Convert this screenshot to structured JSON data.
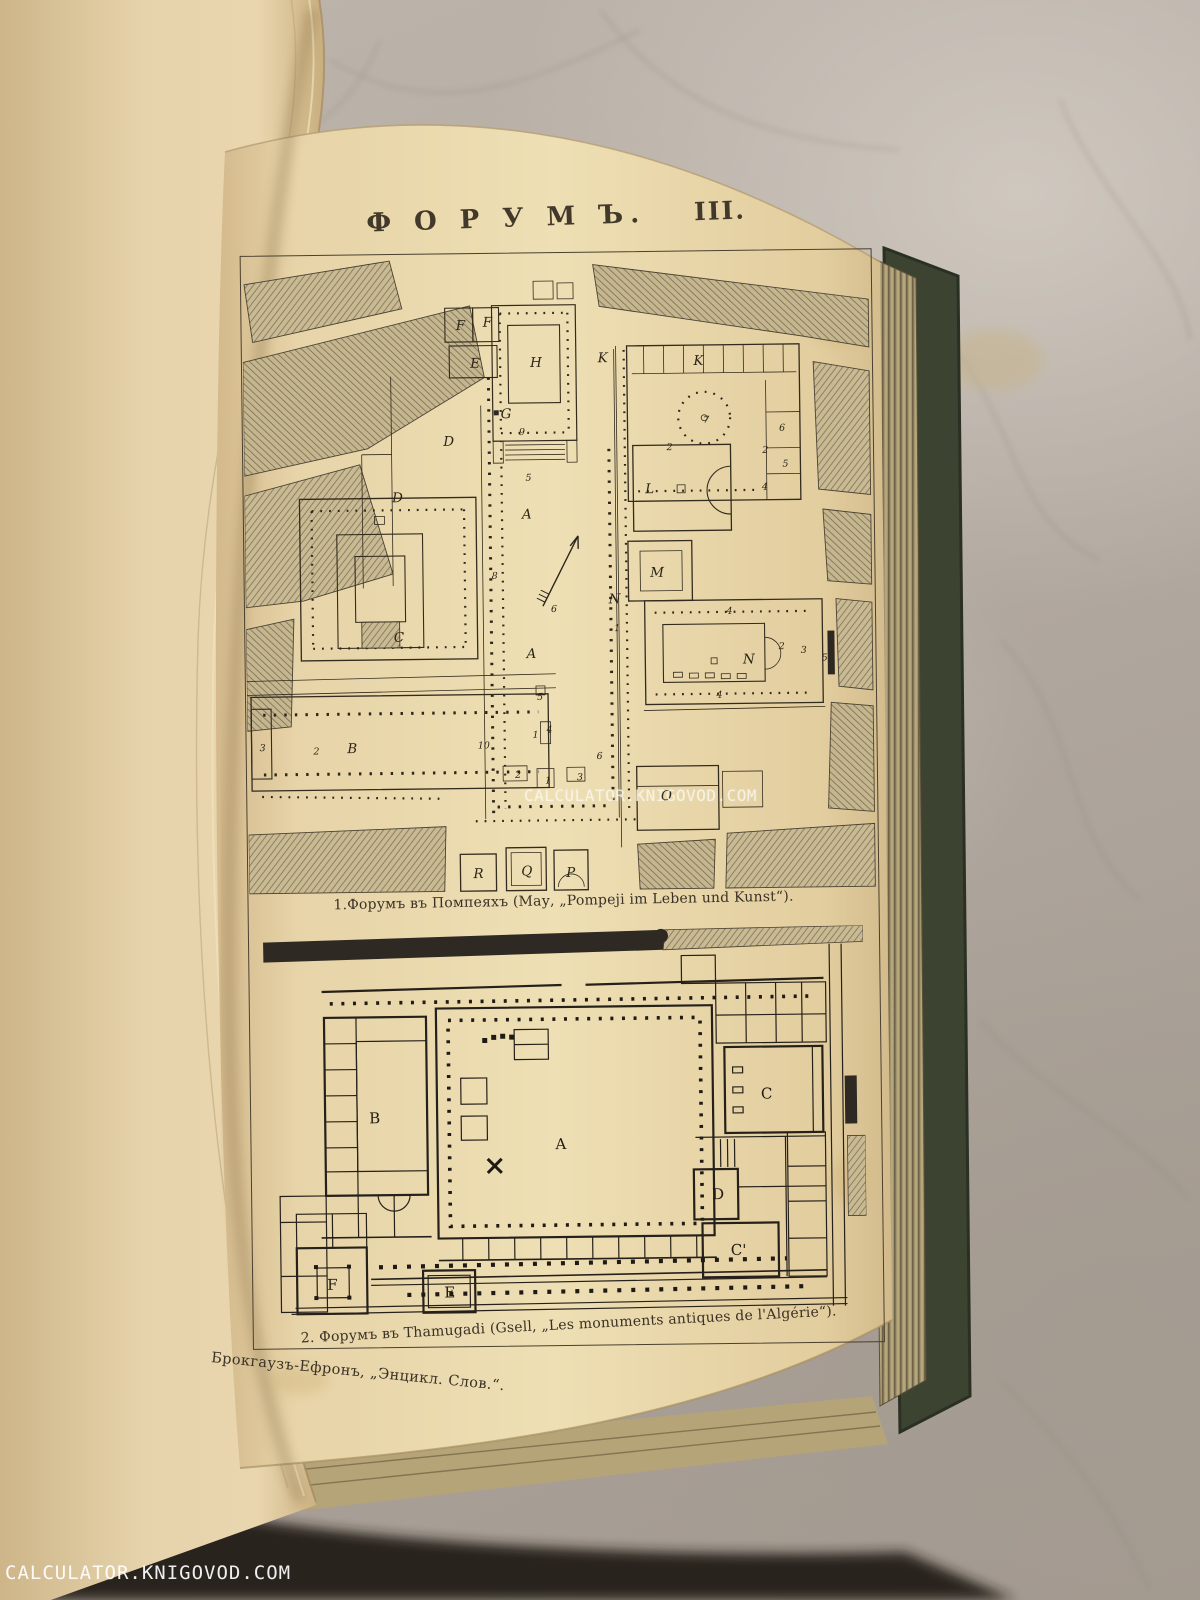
{
  "watermarks": {
    "center": "CALCULATOR.KNIGOVOD.COM",
    "corner": "CALCULATOR.KNIGOVOD.COM"
  },
  "plate": {
    "title": "Ф О Р У М Ъ.",
    "title_numeral": "III.",
    "fig1": {
      "caption": "1.Форумъ въ Помпеяхъ (Мау, „Pompeji im Leben und Kunst“).",
      "letters": [
        {
          "t": "F",
          "x": 214,
          "y": 74
        },
        {
          "t": "F",
          "x": 241,
          "y": 71
        },
        {
          "t": "E",
          "x": 228,
          "y": 112
        },
        {
          "t": "D",
          "x": 200,
          "y": 190
        },
        {
          "t": "D",
          "x": 148,
          "y": 246
        },
        {
          "t": "G",
          "x": 258,
          "y": 163
        },
        {
          "t": "H",
          "x": 288,
          "y": 112
        },
        {
          "t": "K",
          "x": 356,
          "y": 108
        },
        {
          "t": "K",
          "x": 452,
          "y": 112
        },
        {
          "t": "L",
          "x": 402,
          "y": 240
        },
        {
          "t": "M",
          "x": 406,
          "y": 324
        },
        {
          "t": "N",
          "x": 364,
          "y": 350
        },
        {
          "t": "N",
          "x": 498,
          "y": 412
        },
        {
          "t": "A",
          "x": 278,
          "y": 264
        },
        {
          "t": "A",
          "x": 281,
          "y": 404
        },
        {
          "t": "C",
          "x": 148,
          "y": 386
        },
        {
          "t": "B",
          "x": 100,
          "y": 497
        },
        {
          "t": "O",
          "x": 414,
          "y": 548
        },
        {
          "t": "R",
          "x": 225,
          "y": 624
        },
        {
          "t": "Q",
          "x": 273,
          "y": 622
        },
        {
          "t": "P",
          "x": 318,
          "y": 624
        }
      ],
      "numbers": [
        {
          "t": "9",
          "x": 276,
          "y": 180
        },
        {
          "t": "5",
          "x": 282,
          "y": 226
        },
        {
          "t": "8",
          "x": 247,
          "y": 324
        },
        {
          "t": "6",
          "x": 306,
          "y": 358
        },
        {
          "t": "10",
          "x": 231,
          "y": 494
        },
        {
          "t": "5",
          "x": 291,
          "y": 446
        },
        {
          "t": "4",
          "x": 300,
          "y": 479
        },
        {
          "t": "2",
          "x": 268,
          "y": 524
        },
        {
          "t": "1",
          "x": 298,
          "y": 530
        },
        {
          "t": "3",
          "x": 330,
          "y": 527
        },
        {
          "t": "6",
          "x": 350,
          "y": 506
        },
        {
          "t": "7",
          "x": 461,
          "y": 170
        },
        {
          "t": "2",
          "x": 424,
          "y": 197
        },
        {
          "t": "2",
          "x": 520,
          "y": 201
        },
        {
          "t": "4",
          "x": 519,
          "y": 238
        },
        {
          "t": "5",
          "x": 540,
          "y": 215
        },
        {
          "t": "6",
          "x": 537,
          "y": 179
        },
        {
          "t": "1",
          "x": 369,
          "y": 378
        },
        {
          "t": "4",
          "x": 482,
          "y": 362
        },
        {
          "t": "4",
          "x": 471,
          "y": 446
        },
        {
          "t": "2",
          "x": 534,
          "y": 398
        },
        {
          "t": "3",
          "x": 556,
          "y": 402
        },
        {
          "t": "5",
          "x": 577,
          "y": 410
        },
        {
          "t": "2",
          "x": 66,
          "y": 498
        },
        {
          "t": "1",
          "x": 286,
          "y": 484
        },
        {
          "t": "3",
          "x": 12,
          "y": 494
        }
      ]
    },
    "fig2": {
      "caption": "2. Форумъ въ Thamugadi (Gsell, „Les monuments antiques de l'Algérie“).",
      "letters": [
        {
          "t": "B",
          "x": 104,
          "y": 192
        },
        {
          "t": "A",
          "x": 290,
          "y": 220
        },
        {
          "t": "C",
          "x": 496,
          "y": 172
        },
        {
          "t": "D",
          "x": 446,
          "y": 272
        },
        {
          "t": "C'",
          "x": 464,
          "y": 328
        },
        {
          "t": "F",
          "x": 60,
          "y": 358
        },
        {
          "t": "E",
          "x": 177,
          "y": 367
        }
      ]
    },
    "imprint": "Брокгаузъ-Ефронъ, „Энцикл. Слов.“."
  },
  "colors": {
    "paper": "#e9d7a9",
    "cover_green": "#3c4431",
    "page_edges": "#a3946c",
    "marble": "#b6aea4",
    "ink": "#332b1e"
  }
}
